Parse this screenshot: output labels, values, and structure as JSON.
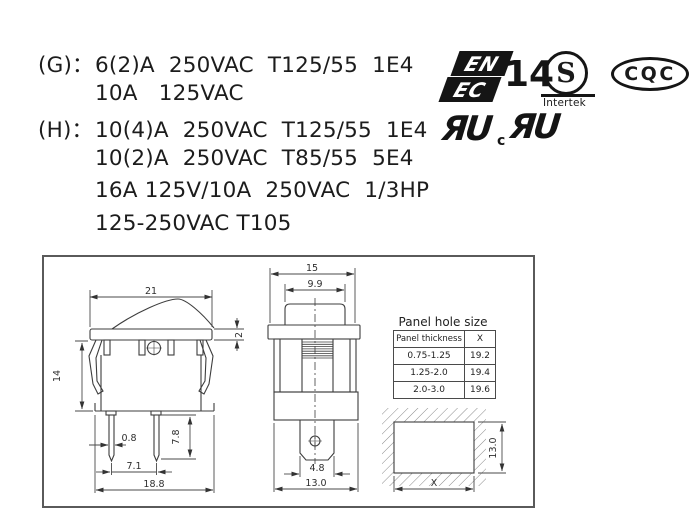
{
  "colors": {
    "ink": "#1a1a1a",
    "line": "#3d3d3d"
  },
  "ratings": {
    "lines": [
      {
        "label": "(G)：",
        "text": "6(2)A  250VAC  T125/55  1E4"
      },
      {
        "label": "",
        "text": "10A   125VAC"
      },
      {
        "label": "(H)：",
        "text": "10(4)A  250VAC  T125/55  1E4"
      },
      {
        "label": "",
        "text": "10(2)A  250VAC  T85/55  5E4"
      },
      {
        "label": "",
        "text": "16A 125V/10A  250VAC  1/3HP"
      },
      {
        "label": "",
        "text": "125-250VAC T105"
      }
    ]
  },
  "certifications": {
    "enec": {
      "line1": "EN",
      "line2": "EC",
      "number": "14"
    },
    "intertek": {
      "symbol": "S",
      "name": "Intertek"
    },
    "cqc": {
      "label": "CQC"
    },
    "ul": {
      "us_mark": "ЯU",
      "canada_prefix": "c",
      "canada_mark": "ЯU"
    }
  },
  "drawings": {
    "side_view": {
      "overall_width": "21",
      "bezel_thickness": "2",
      "body_height": "14",
      "pin_width": "0.8",
      "pin_length": "7.8",
      "pin_pitch": "7.1",
      "base_width": "18.8"
    },
    "front_view": {
      "overall_width": "15",
      "rocker_width": "9.9",
      "terminal_width": "4.8",
      "body_width": "13.0"
    },
    "panel_cutout": {
      "width_label": "X",
      "height": "13.0"
    },
    "panel_hole_table": {
      "title": "Panel hole size",
      "headers": [
        "Panel thickness",
        "X"
      ],
      "rows": [
        [
          "0.75-1.25",
          "19.2"
        ],
        [
          "1.25-2.0",
          "19.4"
        ],
        [
          "2.0-3.0",
          "19.6"
        ]
      ]
    }
  }
}
